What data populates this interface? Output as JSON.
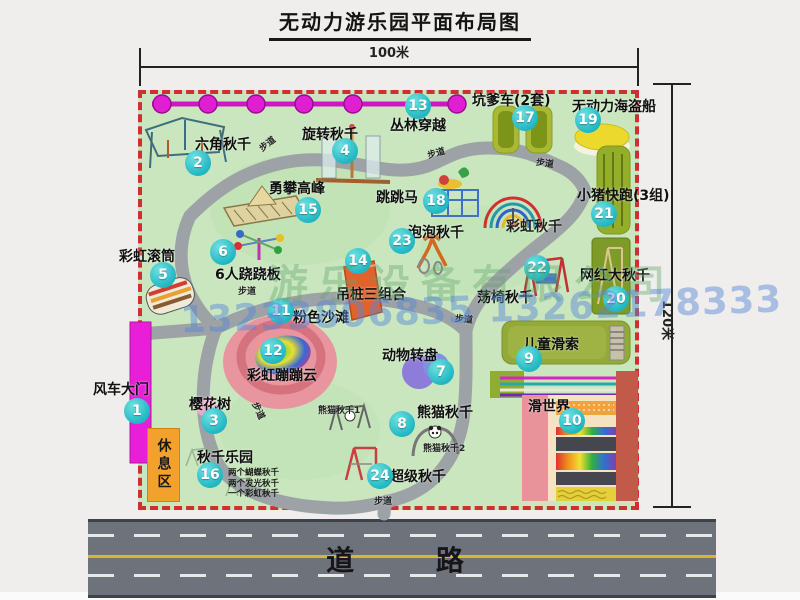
{
  "title": "无动力游乐园平面布局图",
  "dimensions": {
    "width_label": "100米",
    "height_label": "120米"
  },
  "road": {
    "label": "道 路"
  },
  "watermark": {
    "company": "游乐设备有限公司",
    "phone": "13233806835 13262178333"
  },
  "map": {
    "rest_area_label": "休息区",
    "attractions": [
      {
        "num": "1",
        "name": "风车大门",
        "bx": 137,
        "by": 411,
        "lx": 93,
        "ly": 379
      },
      {
        "num": "2",
        "name": "六角秋千",
        "bx": 198,
        "by": 163,
        "lx": 195,
        "ly": 134
      },
      {
        "num": "3",
        "name": "樱花树",
        "bx": 214,
        "by": 421,
        "lx": 189,
        "ly": 394
      },
      {
        "num": "4",
        "name": "旋转秋千",
        "bx": 345,
        "by": 151,
        "lx": 302,
        "ly": 124
      },
      {
        "num": "5",
        "name": "彩虹滚筒",
        "bx": 163,
        "by": 275,
        "lx": 119,
        "ly": 246
      },
      {
        "num": "6",
        "name": "6人跷跷板",
        "bx": 223,
        "by": 252,
        "lx": 215,
        "ly": 264
      },
      {
        "num": "7",
        "name": "动物转盘",
        "bx": 441,
        "by": 372,
        "lx": 382,
        "ly": 345
      },
      {
        "num": "8",
        "name": "熊猫秋千",
        "bx": 402,
        "by": 424,
        "lx": 417,
        "ly": 402
      },
      {
        "num": "9",
        "name": "儿童滑索",
        "bx": 529,
        "by": 359,
        "lx": 523,
        "ly": 334
      },
      {
        "num": "10",
        "name": "滑世界",
        "bx": 572,
        "by": 421,
        "lx": 528,
        "ly": 396
      },
      {
        "num": "11",
        "name": "粉色沙滩",
        "bx": 281,
        "by": 311,
        "lx": 293,
        "ly": 307
      },
      {
        "num": "12",
        "name": "彩虹蹦蹦云",
        "bx": 273,
        "by": 351,
        "lx": 247,
        "ly": 365
      },
      {
        "num": "13",
        "name": "丛林穿越",
        "bx": 418,
        "by": 106,
        "lx": 390,
        "ly": 115
      },
      {
        "num": "14",
        "name": "吊桩三组合",
        "bx": 358,
        "by": 261,
        "lx": 336,
        "ly": 284
      },
      {
        "num": "15",
        "name": "勇攀高峰",
        "bx": 308,
        "by": 210,
        "lx": 269,
        "ly": 178
      },
      {
        "num": "16",
        "name": "秋千乐园",
        "bx": 210,
        "by": 475,
        "lx": 197,
        "ly": 447,
        "notes": [
          "两个蝴蝶秋千",
          "两个发光秋千",
          "一个彩虹秋千"
        ],
        "nx": 228,
        "ny": 468
      },
      {
        "num": "17",
        "name": "坑爹车(2套)",
        "bx": 525,
        "by": 118,
        "lx": 472,
        "ly": 90
      },
      {
        "num": "18",
        "name": "跳跳马",
        "bx": 436,
        "by": 201,
        "lx": 376,
        "ly": 187
      },
      {
        "num": "19",
        "name": "无动力海盗船",
        "bx": 588,
        "by": 120,
        "lx": 572,
        "ly": 96
      },
      {
        "num": "20",
        "name": "网红大秋千",
        "bx": 616,
        "by": 299,
        "lx": 580,
        "ly": 265
      },
      {
        "num": "21",
        "name": "小猪快跑(3组)",
        "bx": 604,
        "by": 214,
        "lx": 577,
        "ly": 185
      },
      {
        "num": "22",
        "name": "荡椅秋千",
        "bx": 537,
        "by": 268,
        "lx": 477,
        "ly": 287
      },
      {
        "num": "23",
        "name": "泡泡秋千",
        "bx": 402,
        "by": 241,
        "lx": 408,
        "ly": 222
      },
      {
        "num": "24",
        "name": "超级秋千",
        "bx": 380,
        "by": 476,
        "lx": 390,
        "ly": 466
      }
    ],
    "extra_labels": [
      {
        "text": "彩虹秋千",
        "x": 506,
        "y": 216,
        "fs": 14,
        "rot": 0
      },
      {
        "text": "熊猫秋千1",
        "x": 318,
        "y": 403,
        "fs": 9,
        "rot": 0
      },
      {
        "text": "熊猫秋千2",
        "x": 423,
        "y": 441,
        "fs": 9,
        "rot": 0
      },
      {
        "text": "步道",
        "x": 258,
        "y": 137,
        "fs": 9,
        "rot": -38
      },
      {
        "text": "步道",
        "x": 427,
        "y": 146,
        "fs": 9,
        "rot": -15
      },
      {
        "text": "步道",
        "x": 536,
        "y": 156,
        "fs": 9,
        "rot": 8
      },
      {
        "text": "步道",
        "x": 238,
        "y": 284,
        "fs": 9,
        "rot": 0
      },
      {
        "text": "步道",
        "x": 455,
        "y": 312,
        "fs": 9,
        "rot": 6
      },
      {
        "text": "步道",
        "x": 250,
        "y": 404,
        "fs": 9,
        "rot": 65
      },
      {
        "text": "步道",
        "x": 374,
        "y": 494,
        "fs": 9,
        "rot": 0
      }
    ]
  }
}
